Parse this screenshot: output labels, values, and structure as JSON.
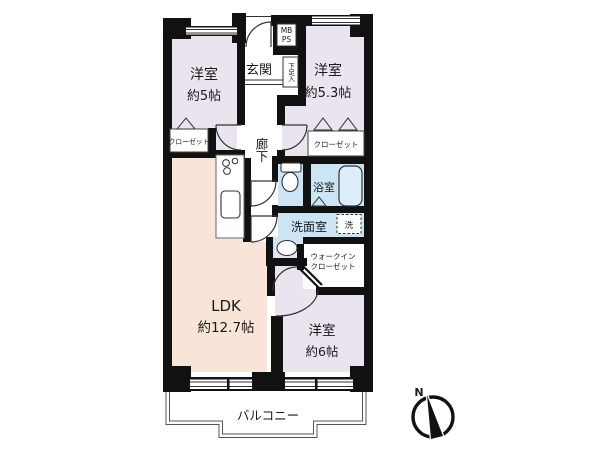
{
  "rooms": {
    "bedroom_5": {
      "name": "洋室",
      "size": "約5帖"
    },
    "bedroom_53": {
      "name": "洋室",
      "size": "約5.3帖"
    },
    "bedroom_6": {
      "name": "洋室",
      "size": "約6帖"
    },
    "ldk": {
      "name": "LDK",
      "size": "約12.7帖"
    }
  },
  "labels": {
    "entrance": "玄関",
    "hallway": "廊下",
    "bath": "浴室",
    "washroom": "洗面室",
    "washer": "洗",
    "balcony": "バルコニー",
    "closet_left": "クローゼット",
    "closet_right": "クローゼット",
    "wic_line1": "ウォークイン",
    "wic_line2": "クローゼット",
    "shoe_cabinet": "下足入",
    "mb": "MB",
    "ps": "PS"
  },
  "compass": {
    "north": "N"
  },
  "colors": {
    "bedroom_fill": "#eae4ee",
    "ldk_fill": "#f8e5d8",
    "wet_area_fill": "#cbe5f5",
    "wall": "#111111",
    "line": "#333333"
  }
}
